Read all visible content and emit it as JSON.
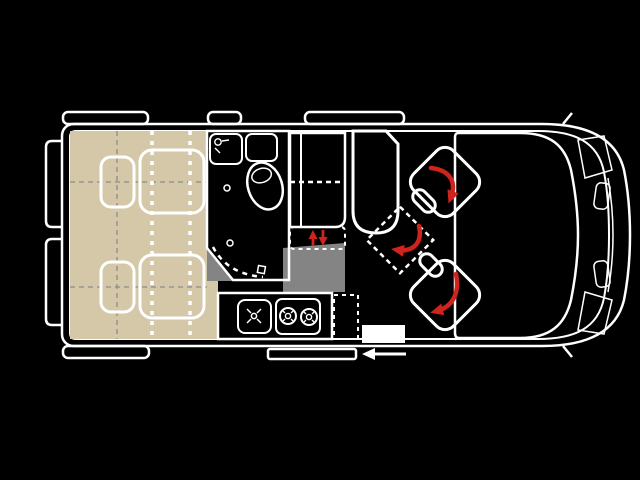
{
  "diagram": {
    "title": "campervan-floorplan",
    "colors": {
      "background": "#000000",
      "van_wall": "#9c9c9c",
      "floor": "#9d9d9d",
      "floor_shadow": "#848484",
      "bed": "#d5c8a8",
      "bathroom": "#c7d8e2",
      "bathroom_fixture": "#b5cad8",
      "toilet": "#a9bfcc",
      "cabinet": "#d9d4b4",
      "cabinet_flap": "#efeadb",
      "kitchen": "#dae1d5",
      "kitchen_flap": "#cfd6cb",
      "appliance": "#b2b7b2",
      "seat_bench": "#e5b9ae",
      "table": "#e2b7ad",
      "swivel_seat": "#e4e1c7",
      "cab_glass": "#d9d9d9",
      "step": "#ffffff",
      "arrow_red": "#cf231d",
      "marker_white": "#ffffff"
    },
    "elements": {
      "beds": {
        "count": 2,
        "pillows": 2,
        "mattresses": 2
      },
      "bathroom": {
        "fixtures": [
          "washbasin",
          "counter",
          "toilet"
        ],
        "door_swing": "dashed-arc"
      },
      "tall_cabinet": {
        "flap": "drop-down",
        "flap_motion": "up-down-arrows"
      },
      "kitchen": {
        "appliances": [
          "sink",
          "two-burner-stove"
        ],
        "extension_flap": "dashed"
      },
      "lounge": {
        "bench_seat": 1,
        "rotating_table": 1,
        "swivel_cab_seats": 2,
        "rotation_arrows": 3
      },
      "cab": {
        "windshield": 1,
        "headlights": 2,
        "side_markers": 2,
        "mirrors": 2
      },
      "openings": {
        "top_windows": 3,
        "bottom_window": 1,
        "rear_doors": 2,
        "sliding_door": 1,
        "entry_step": 1,
        "slide_direction": "left"
      }
    }
  }
}
